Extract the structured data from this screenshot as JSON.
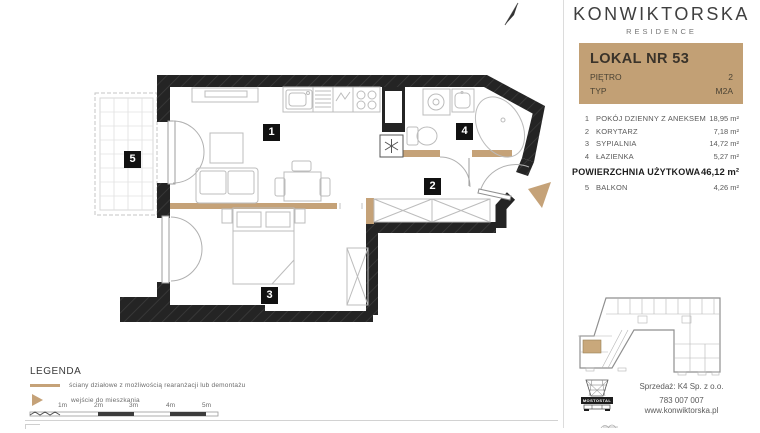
{
  "brand": {
    "name": "KONWIKTORSKA",
    "residence": "RESIDENCE"
  },
  "unit": {
    "title": "LOKAL NR 53",
    "floor_label": "PIĘTRO",
    "floor_value": "2",
    "type_label": "TYP",
    "type_value": "M2A"
  },
  "rooms": [
    {
      "no": "1",
      "name": "POKÓJ DZIENNY Z ANEKSEM",
      "area": "18,95 m²"
    },
    {
      "no": "2",
      "name": "KORYTARZ",
      "area": "7,18 m²"
    },
    {
      "no": "3",
      "name": "SYPIALNIA",
      "area": "14,72 m²"
    },
    {
      "no": "4",
      "name": "ŁAZIENKA",
      "area": "5,27 m²"
    }
  ],
  "total": {
    "label": "POWIERZCHNIA UŻYTKOWA",
    "value": "46,12 m²"
  },
  "balcony_row": {
    "no": "5",
    "name": "BALKON",
    "area": "4,26 m²"
  },
  "legend": {
    "title": "LEGENDA",
    "partition_label": "ściany działowe z możliwością rearanżacji lub demontażu",
    "entrance_label": "wejście do mieszkania"
  },
  "scale": {
    "ticks": [
      "1m",
      "2m",
      "3m",
      "4m",
      "5m"
    ]
  },
  "contact": {
    "developer": "MOSTOSTAL",
    "seller": "Sprzedaż: K4 Sp. z o.o.",
    "phone": "783 007 007",
    "website": "www.konwiktorska.pl"
  },
  "colors": {
    "accent": "#c3a176",
    "wall": "#242424",
    "unit_card_bg": "#c2a075"
  }
}
